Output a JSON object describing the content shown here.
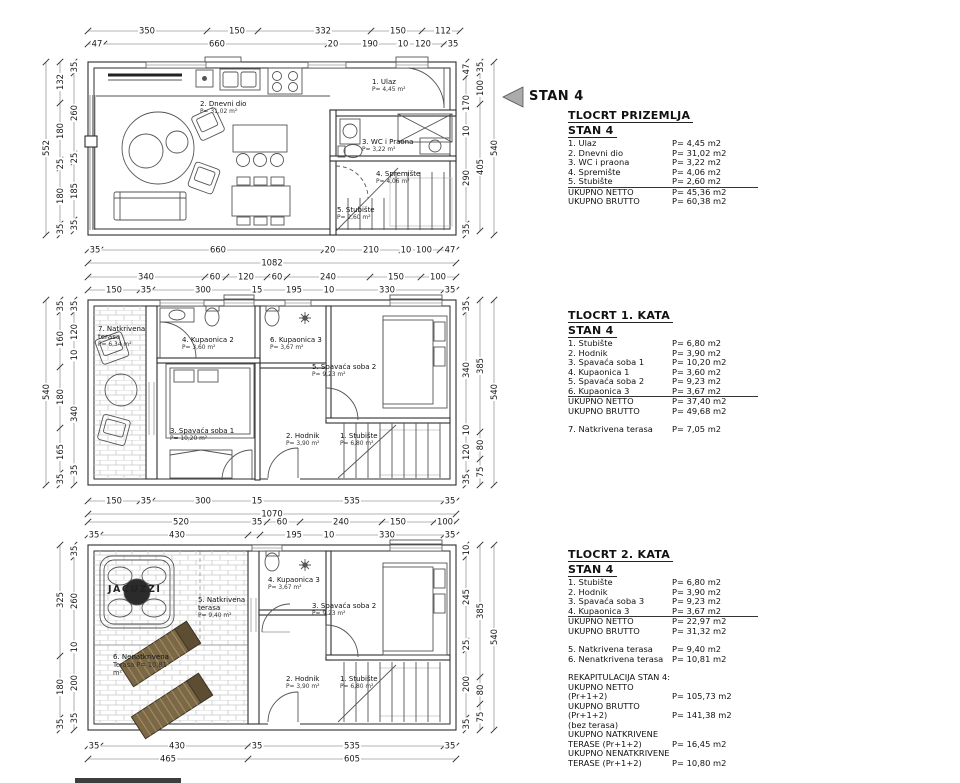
{
  "marker": {
    "label": "STAN 4"
  },
  "legends": [
    {
      "title": "TLOCRT PRIZEMLJA",
      "subtitle": "STAN 4",
      "rows": [
        {
          "name": "1. Ulaz",
          "value": "P= 4,45 m2"
        },
        {
          "name": "2. Dnevni dio",
          "value": "P= 31,02 m2"
        },
        {
          "name": "3. WC i praona",
          "value": "P= 3,22 m2"
        },
        {
          "name": "4. Spremište",
          "value": "P= 4,06 m2"
        },
        {
          "name": "5. Stubište",
          "value": "P= 2,60 m2"
        },
        {
          "name": "UKUPNO NETTO",
          "value": "P= 45,36 m2"
        },
        {
          "name": "UKUPNO BRUTTO",
          "value": "P= 60,38 m2"
        }
      ]
    },
    {
      "title": "TLOCRT 1. KATA",
      "subtitle": "STAN 4",
      "rows": [
        {
          "name": "1. Stubište",
          "value": "P= 6,80 m2"
        },
        {
          "name": "2. Hodnik",
          "value": "P= 3,90 m2"
        },
        {
          "name": "3. Spavaća soba 1",
          "value": "P= 10,20 m2"
        },
        {
          "name": "4. Kupaonica 1",
          "value": "P= 3,60 m2"
        },
        {
          "name": "5. Spavaća soba 2",
          "value": "P= 9,23 m2"
        },
        {
          "name": "6. Kupaonica 3",
          "value": "P= 3,67 m2"
        },
        {
          "name": "UKUPNO NETTO",
          "value": "P= 37,40 m2"
        },
        {
          "name": "UKUPNO BRUTTO",
          "value": "P= 49,68 m2"
        },
        {
          "name": "7. Natkrivena terasa",
          "value": "P= 7,05 m2"
        }
      ]
    },
    {
      "title": "TLOCRT 2. KATA",
      "subtitle": "STAN 4",
      "rows": [
        {
          "name": "1. Stubište",
          "value": "P= 6,80 m2"
        },
        {
          "name": "2. Hodnik",
          "value": "P= 3,90 m2"
        },
        {
          "name": "3. Spavaća soba 3",
          "value": "P= 9,23 m2"
        },
        {
          "name": "4. Kupaonica 3",
          "value": "P= 3,67 m2"
        },
        {
          "name": "UKUPNO NETTO",
          "value": "P= 22,97 m2"
        },
        {
          "name": "UKUPNO BRUTTO",
          "value": "P= 31,32 m2"
        },
        {
          "name": "5. Natkrivena terasa",
          "value": "P= 9,40 m2"
        },
        {
          "name": "6. Nenatkrivena terasa",
          "value": "P= 10,81 m2"
        },
        {
          "name": "REKAPITULACIJA STAN 4:",
          "value": ""
        },
        {
          "name": "UKUPNO NETTO (Pr+1+2)",
          "value": "P= 105,73 m2"
        },
        {
          "name": "UKUPNO BRUTTO (Pr+1+2)",
          "value": "P= 141,38 m2"
        },
        {
          "name": "(bez terasa)",
          "value": ""
        },
        {
          "name": "UKUPNO NATKRIVENE",
          "value": ""
        },
        {
          "name": "TERASE (Pr+1+2)",
          "value": "P= 16,45 m2"
        },
        {
          "name": "UKUPNO NENATKRIVENE",
          "value": ""
        },
        {
          "name": "TERASE (Pr+1+2)",
          "value": "P= 10,80 m2"
        }
      ]
    }
  ],
  "plans": [
    {
      "name": "prizemlje",
      "rooms": [
        {
          "n": "1. Ulaz",
          "a": "P= 4,45 m²"
        },
        {
          "n": "2. Dnevni dio",
          "a": "P= 31,02 m²"
        },
        {
          "n": "3. WC i Praona",
          "a": "P= 3,22 m²"
        },
        {
          "n": "4. Spremište",
          "a": "P= 4,06 m²"
        },
        {
          "n": "5. Stubište",
          "a": "P= 2,60 m²"
        }
      ],
      "dims": {
        "t1": [
          "350",
          "150",
          "332",
          "150",
          "112"
        ],
        "t2": [
          "47",
          "660",
          "20",
          "190",
          "10",
          "120",
          "35"
        ],
        "b1": [
          "35",
          "660",
          "20",
          "210",
          "10",
          "100",
          "47"
        ],
        "b2": [
          "1082"
        ],
        "l0": [
          "552"
        ],
        "l1": [
          "132",
          "180",
          "25",
          "180",
          "35"
        ],
        "l2": [
          "35",
          "260",
          "25",
          "185",
          "35"
        ],
        "r1": [
          "47",
          "170",
          "10",
          "290",
          "35"
        ],
        "r2": [
          "35",
          "100",
          "405"
        ],
        "r0": [
          "540"
        ]
      }
    },
    {
      "name": "1. kat",
      "rooms": [
        {
          "n": "7. Natkrivena terasa",
          "a": "P= 6,34 m²"
        },
        {
          "n": "4. Kupaonica 2",
          "a": "P= 3,60 m²"
        },
        {
          "n": "6. Kupaonica 3",
          "a": "P= 3,67 m²"
        },
        {
          "n": "5. Spavaća soba 2",
          "a": "P= 9,23 m²"
        },
        {
          "n": "3. Spavaća soba 1",
          "a": "P= 10,20 m²"
        },
        {
          "n": "2. Hodnik",
          "a": "P= 3,90 m²"
        },
        {
          "n": "1. Stubište",
          "a": "P= 6,80 m²"
        }
      ],
      "dims": {
        "t1": [
          "340",
          "60",
          "120",
          "60",
          "240",
          "150",
          "100"
        ],
        "t2": [
          "150",
          "35",
          "300",
          "15",
          "195",
          "10",
          "330",
          "35"
        ],
        "b1": [
          "150",
          "35",
          "300",
          "15",
          "535",
          "35"
        ],
        "b2": [
          "1070"
        ],
        "l0": [
          "540"
        ],
        "l1": [
          "35",
          "160",
          "180",
          "165",
          "35"
        ],
        "l2": [
          "35",
          "120",
          "10",
          "340",
          "35"
        ],
        "r1": [
          "35",
          "340",
          "10",
          "120",
          "35"
        ],
        "r2": [
          "385",
          "80",
          "75"
        ],
        "r0": [
          "540"
        ]
      }
    },
    {
      "name": "2. kat",
      "rooms": [
        {
          "n": "JACUZZI",
          "a": ""
        },
        {
          "n": "5. Natkrivena terasa",
          "a": "P= 9,40 m²"
        },
        {
          "n": "4. Kupaonica 3",
          "a": "P= 3,67 m²"
        },
        {
          "n": "3. Spavaća soba 2",
          "a": "P= 9,23 m²"
        },
        {
          "n": "6. Nenatkrivena",
          "a": "Terasa P= 10,81 m²"
        },
        {
          "n": "2. Hodnik",
          "a": "P= 3,90 m²"
        },
        {
          "n": "1. Stubište",
          "a": "P= 6,80 m²"
        }
      ],
      "dims": {
        "t1": [
          "520",
          "35",
          "60",
          "240",
          "150",
          "100"
        ],
        "t2": [
          "35",
          "430",
          "195",
          "10",
          "330",
          "35"
        ],
        "b1": [
          "35",
          "430",
          "35",
          "535",
          "35"
        ],
        "b2": [
          "465",
          "605"
        ],
        "l1": [
          "325",
          "180",
          "35"
        ],
        "l2": [
          "35",
          "260",
          "10",
          "200",
          "35"
        ],
        "r1": [
          "10",
          "245",
          "25",
          "200",
          "35"
        ],
        "r2": [
          "385",
          "80",
          "75"
        ],
        "r0": [
          "540"
        ]
      }
    }
  ]
}
